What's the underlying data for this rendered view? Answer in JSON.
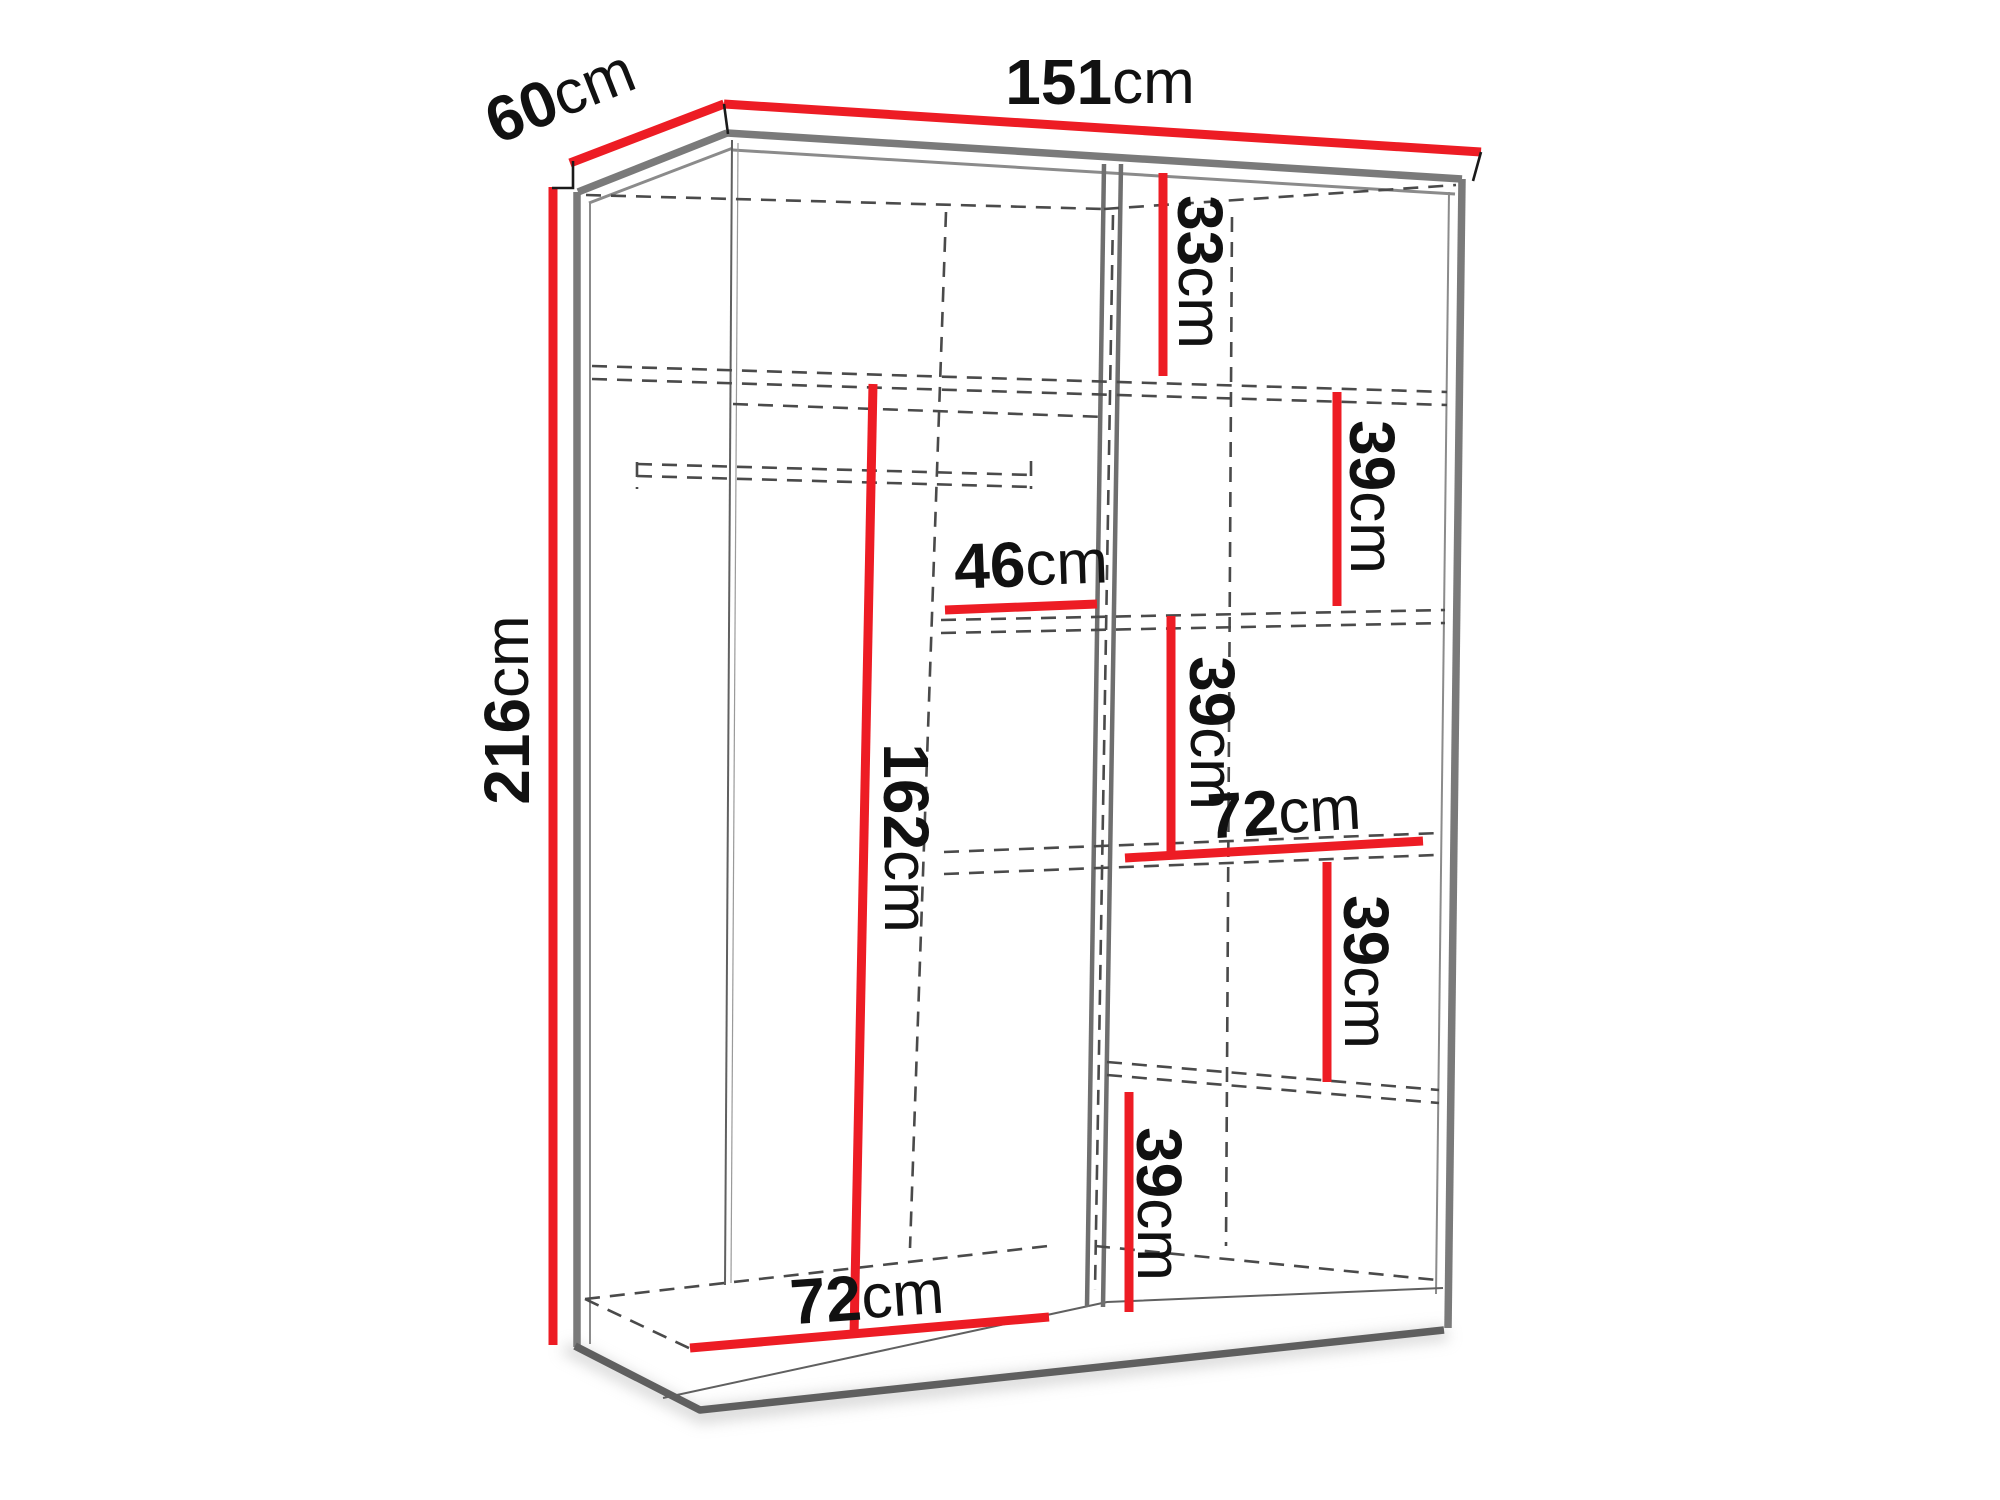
{
  "diagram_title": "Wardrobe dimension diagram",
  "colors": {
    "dimension_red": "#ed1c24",
    "outline_gray": "#7a7a7a",
    "dashed_gray": "#4a4a4a",
    "text_black": "#111111"
  },
  "dimensions": {
    "total_width": {
      "value": "151",
      "unit": "cm"
    },
    "total_depth": {
      "value": "60",
      "unit": "cm"
    },
    "total_height": {
      "value": "216",
      "unit": "cm"
    },
    "top_right_gap": {
      "value": "33",
      "unit": "cm"
    },
    "upper_right_gap": {
      "value": "39",
      "unit": "cm"
    },
    "middle_shelf_width": {
      "value": "46",
      "unit": "cm"
    },
    "middle_right_gap": {
      "value": "39",
      "unit": "cm"
    },
    "hanging_height": {
      "value": "162",
      "unit": "cm"
    },
    "right_width": {
      "value": "72",
      "unit": "cm"
    },
    "lower_right_gap": {
      "value": "39",
      "unit": "cm"
    },
    "bottom_right_gap": {
      "value": "39",
      "unit": "cm"
    },
    "left_width": {
      "value": "72",
      "unit": "cm"
    }
  }
}
